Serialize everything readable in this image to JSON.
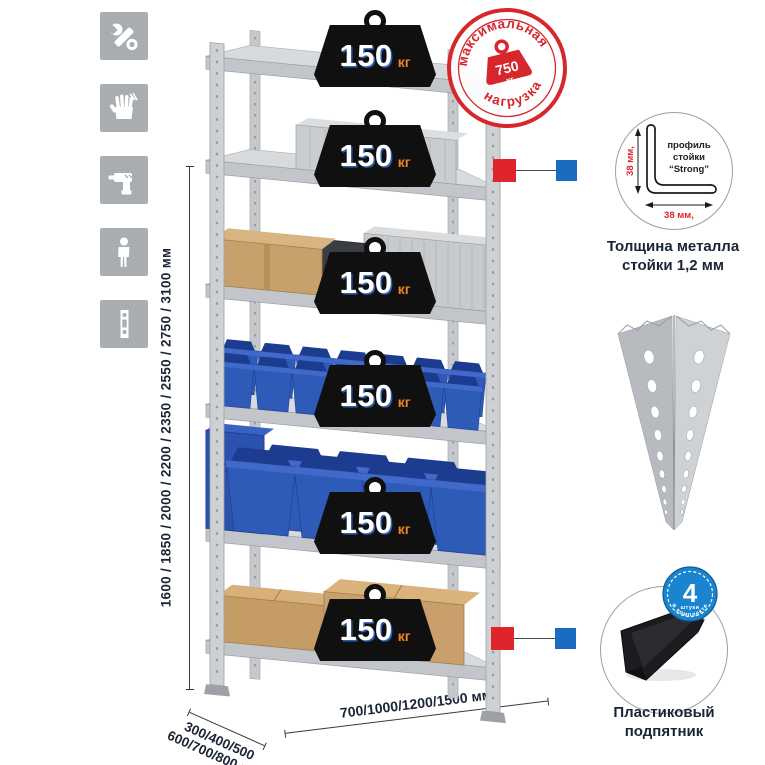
{
  "page": {
    "background": "#ffffff"
  },
  "colors": {
    "accent_red": "#e0242b",
    "accent_blue": "#1b6cc0",
    "stamp_red": "#d7262c",
    "metal_gray": "#c6c9cc",
    "bin_blue": "#2e5ab8",
    "cardboard": "#c8a06c",
    "weight_black": "#101010",
    "weight_unit_orange": "#ee8324",
    "icon_bg_gray": "#a8adb2",
    "dim_text_navy": "#1a2436"
  },
  "left_icons": [
    {
      "name": "wrench-icon"
    },
    {
      "name": "gloves-icon"
    },
    {
      "name": "drill-icon"
    },
    {
      "name": "person-icon"
    },
    {
      "name": "post-profile-icon"
    }
  ],
  "height_dimension": {
    "label": "1600 / 1850 / 2000 / 2200 / 2350 / 2550 / 2750 / 3100 мм"
  },
  "rack": {
    "shelf_count": 6,
    "weights": [
      {
        "value": "150",
        "unit": "кг"
      },
      {
        "value": "150",
        "unit": "кг"
      },
      {
        "value": "150",
        "unit": "кг"
      },
      {
        "value": "150",
        "unit": "кг"
      },
      {
        "value": "150",
        "unit": "кг"
      },
      {
        "value": "150",
        "unit": "кг"
      }
    ]
  },
  "max_load_stamp": {
    "arc_top": "максимальная",
    "arc_bottom": "нагрузка",
    "value": "750",
    "unit": "кг"
  },
  "profile_detail": {
    "label_line1": "профиль",
    "label_line2": "стойки",
    "label_line3": "“Strong”",
    "vertical_dim": "38 мм,",
    "horizontal_dim": "38 мм,",
    "caption_line1": "Толщина металла",
    "caption_line2": "стойки 1,2 мм"
  },
  "foot_detail": {
    "badge_value": "4",
    "badge_unit": "штуки",
    "badge_arc": "в комплекте",
    "caption_line1": "Пластиковый",
    "caption_line2": "подпятник"
  },
  "depth_dimension": {
    "line1": "300/400/500",
    "line2": "600/700/800 мм"
  },
  "width_dimension": {
    "label": "700/1000/1200/1500 мм"
  }
}
